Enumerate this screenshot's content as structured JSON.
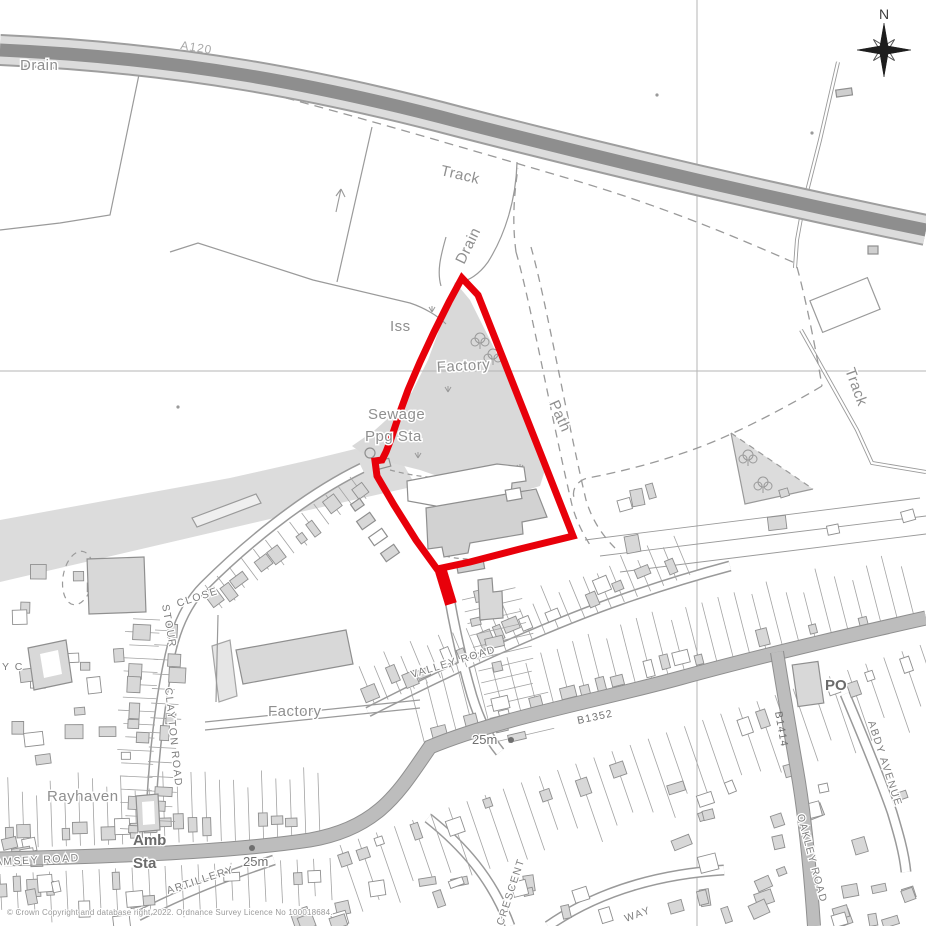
{
  "map": {
    "labels": {
      "drain_nw": "Drain",
      "track_nw": "Track",
      "drain_mid": "Drain",
      "iss": "Iss",
      "factory_site": "Factory",
      "sewage_line1": "Sewage",
      "sewage_line2": "Ppg Sta",
      "path": "Path",
      "track_ne": "Track",
      "a120": "A120",
      "factory_sw": "Factory",
      "rayhaven": "Rayhaven",
      "valley_road": "VALLEY ROAD",
      "b1352": "B1352",
      "b1414": "B1414",
      "oakley_road": "OAKLEY ROAD",
      "abdy_avenue": "ABDY AVENUE",
      "po": "PO",
      "stour": "STOUR",
      "close": "CLOSE",
      "clayton_road": "CLAYTON ROAD",
      "partial_close": "Y C",
      "ramsey_road": "RAMSEY ROAD",
      "amb_line1": "Amb",
      "amb_line2": "Sta",
      "artillery": "ARTILLERY",
      "crescent": "CRESCENT",
      "way": "WAY",
      "spot_25m_a": "25m",
      "spot_25m_b": "25m",
      "north": "N"
    },
    "copyright": "© Crown Copyright and database right 2022. Ordnance Survey Licence No 100018684.",
    "colors": {
      "site_boundary": "#e8000a",
      "road_dark": "#8e8e8e",
      "road_casing": "#dcdcdc",
      "road_band": "#bdbdbd",
      "open_land": "#dcdcdc",
      "building": "#d8d8d8",
      "linework": "#9a9a9a",
      "label": "#8f8f8f",
      "grid": "#b5b5b5"
    }
  }
}
